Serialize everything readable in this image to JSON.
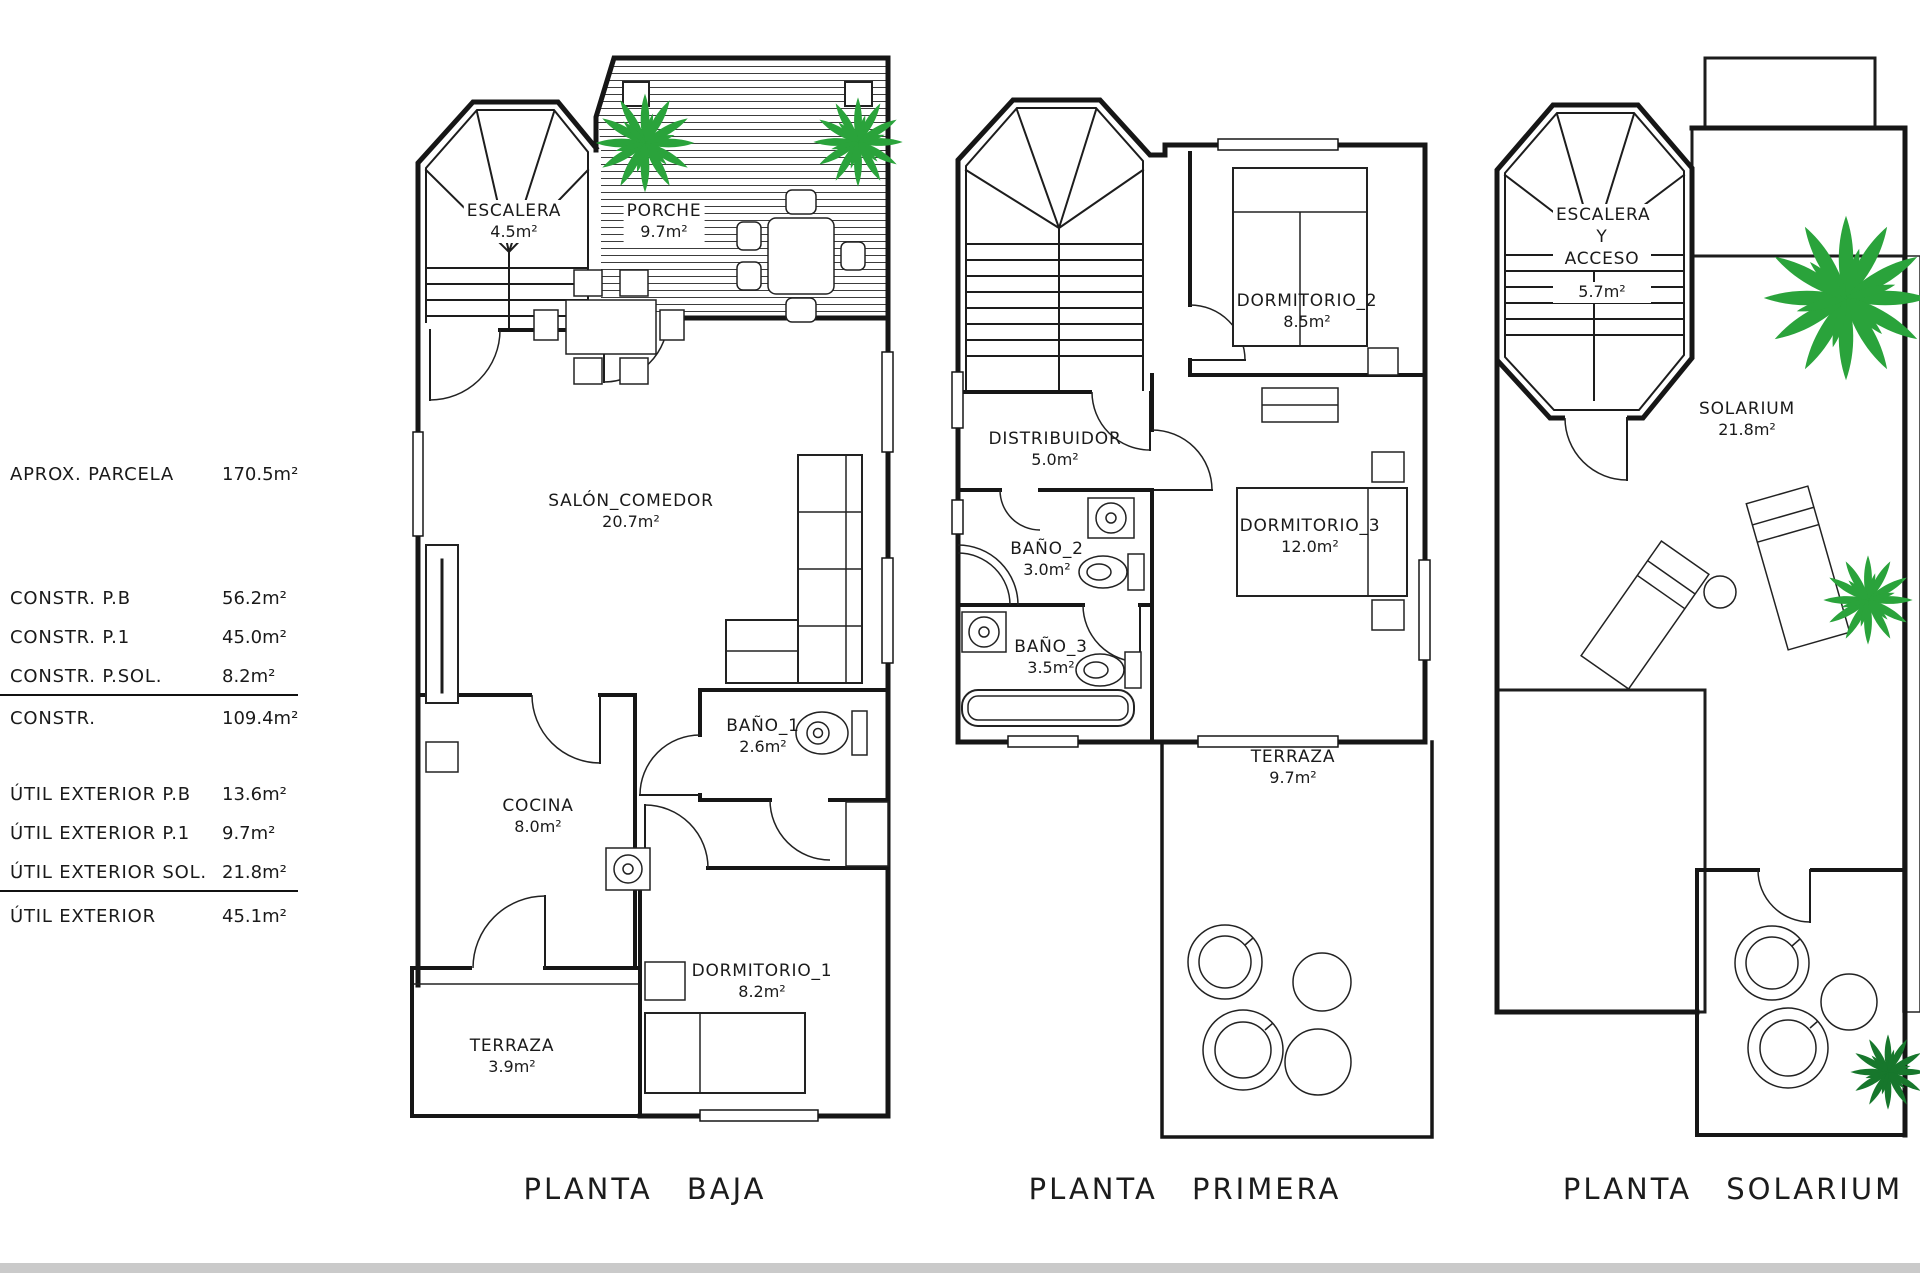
{
  "info_table": {
    "rows": [
      {
        "label": "APROX. PARCELA",
        "value": "170.5m²"
      },
      {
        "label": "CONSTR. P.B",
        "value": "56.2m²"
      },
      {
        "label": "CONSTR. P.1",
        "value": "45.0m²"
      },
      {
        "label": "CONSTR. P.SOL.",
        "value": "8.2m²"
      },
      {
        "label": "CONSTR.",
        "value": "109.4m²"
      },
      {
        "label": "ÚTIL EXTERIOR P.B",
        "value": "13.6m²"
      },
      {
        "label": "ÚTIL EXTERIOR P.1",
        "value": "9.7m²"
      },
      {
        "label": "ÚTIL EXTERIOR SOL.",
        "value": "21.8m²"
      },
      {
        "label": "ÚTIL EXTERIOR",
        "value": "45.1m²"
      }
    ]
  },
  "plans": [
    {
      "caption": "PLANTA BAJA",
      "rooms": [
        {
          "name": "ESCALERA",
          "area": "4.5m²"
        },
        {
          "name": "PORCHE",
          "area": "9.7m²"
        },
        {
          "name": "SALÓN_COMEDOR",
          "area": "20.7m²"
        },
        {
          "name": "COCINA",
          "area": "8.0m²"
        },
        {
          "name": "BAÑO_1",
          "area": "2.6m²"
        },
        {
          "name": "DORMITORIO_1",
          "area": "8.2m²"
        },
        {
          "name": "TERRAZA",
          "area": "3.9m²"
        }
      ]
    },
    {
      "caption": "PLANTA PRIMERA",
      "rooms": [
        {
          "name": "DORMITORIO_2",
          "area": "8.5m²"
        },
        {
          "name": "DISTRIBUIDOR",
          "area": "5.0m²"
        },
        {
          "name": "BAÑO_2",
          "area": "3.0m²"
        },
        {
          "name": "DORMITORIO_3",
          "area": "12.0m²"
        },
        {
          "name": "BAÑO_3",
          "area": "3.5m²"
        },
        {
          "name": "TERRAZA",
          "area": "9.7m²"
        }
      ]
    },
    {
      "caption": "PLANTA SOLARIUM",
      "rooms": [
        {
          "name": "ESCALERA Y ACCESO",
          "area": "5.7m²"
        },
        {
          "name": "SOLARIUM",
          "area": "21.8m²"
        }
      ]
    }
  ],
  "colors": {
    "wall_black": "#161616",
    "palm_green": "#2aa33b",
    "plant_green": "#17772c",
    "footer_bar_gray": "#cacaca"
  }
}
